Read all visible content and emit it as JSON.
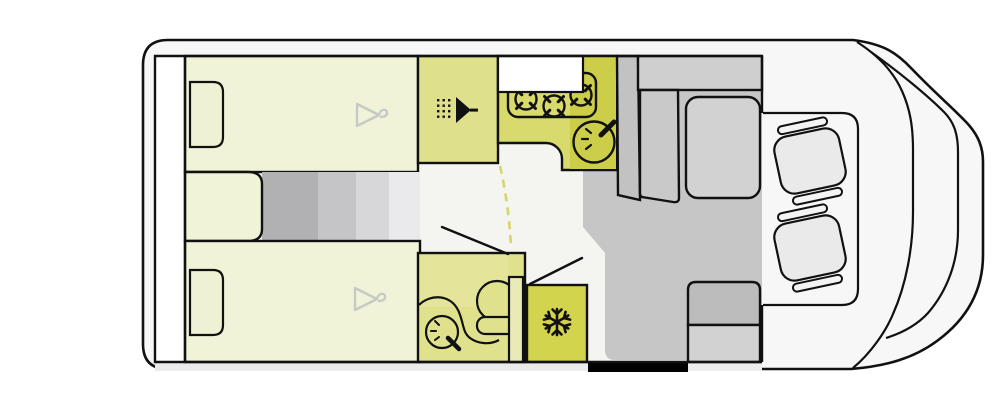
{
  "figure": {
    "type": "motorhome-floorplan",
    "front_direction": "right",
    "beds": 2,
    "hob_burners": 3,
    "cab_seats": 2
  },
  "rooms": {
    "rear_garage": "rear-garage",
    "bed_top": "single-bed-top",
    "bed_bottom": "single-bed-bottom",
    "shower": "shower-cubicle",
    "kitchen": "kitchen-block",
    "bathroom": "washroom",
    "fridge": "refrigerator",
    "lounge": "lounge-dinette",
    "cab": "driver-cab"
  },
  "icons": [
    "hanger-icon",
    "shower-head-icon",
    "burner-icon",
    "faucet-icon",
    "snowflake-icon"
  ],
  "palette": {
    "ink": "#111111",
    "body_fill": "#f7f7f7",
    "interior_fill": "#f4f5f1",
    "garage_fill": "#ffffff",
    "bed_fill": "#f1f3d9",
    "pillow_fill": "#eff1d5",
    "grad1": "#b1b1b3",
    "grad2": "#c5c5c7",
    "grad3": "#d7d7d9",
    "grad4": "#eaeaec",
    "shower_fill": "#dfe08c",
    "kitchen_fill": "#d9da6e",
    "kitchen_dark": "#cccd49",
    "window_fill": "#ffffff",
    "bathroom_fill": "#e0e18c",
    "bathroom_light": "#e4e59b",
    "wall_strip_fill": "#e9eab8",
    "fridge_fill": "#d3d44e",
    "floor_gray": "#c6c6c6",
    "cabinet_gray": "#c2c2c2",
    "backrest_gray": "#cfcfcf",
    "sofa_gray": "#c9c9c9",
    "table_gray": "#d2d2d2",
    "bench_back_gray": "#bcbcbc",
    "bench_seat_gray": "#d2d2d2",
    "seat_fill": "#eaeaea",
    "armrest_fill": "#f4f4f4",
    "hanger_gray": "#c5cac5",
    "dash_line": "#d4d66a",
    "entry_black": "#000000",
    "bottom_strip": "#ebebeb"
  }
}
